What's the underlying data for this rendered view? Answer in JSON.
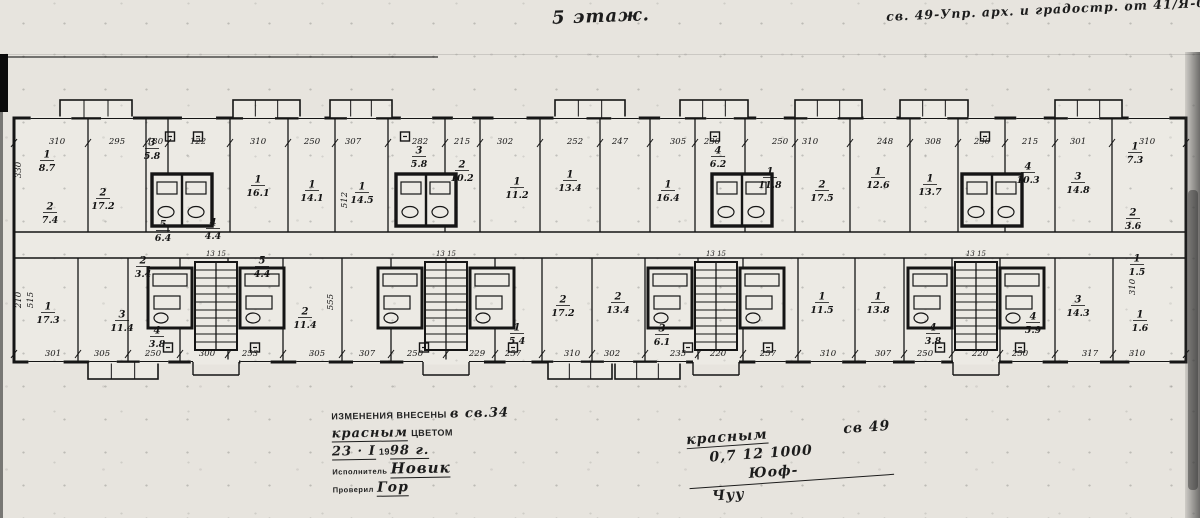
{
  "annotations": {
    "floor_label": "5 этаж.",
    "top_right_note": "св. 49-Упр. арх. и градостр. от 41/Я-04 д 4",
    "stamp_block": {
      "line1_stamp": "ИЗМЕНЕНИЯ ВНЕСЕНЫ",
      "line1_hand": "в св.34",
      "line2_hand": "красным",
      "line2_stamp": "ЦВЕТОМ",
      "line3_hand_day": "23 · I",
      "line3_stamp_year": "19",
      "line3_hand_year": "98 г.",
      "line4_stamp": "Исполнитель",
      "line4_hand": "Новик",
      "line5_stamp": "Проверил",
      "line5_hand": "Гор"
    },
    "center_note": {
      "l1a": "красным",
      "l1b": "св 49",
      "l2": "0,7  12   1000",
      "sig1": "Юоф-",
      "sig2": "Чуу"
    }
  },
  "colors": {
    "paper": "#e7e4de",
    "paper2": "#eceae4",
    "ink": "#151515"
  },
  "plan": {
    "outline": {
      "x": 14,
      "y": 118,
      "w": 1172,
      "h": 244
    },
    "corridor_y": [
      232,
      258
    ],
    "upper_walls_x": [
      88,
      146,
      168,
      230,
      288,
      335,
      388,
      445,
      480,
      540,
      600,
      650,
      695,
      745,
      795,
      850,
      910,
      958,
      1005,
      1055,
      1112
    ],
    "lower_walls_x": [
      78,
      128,
      180,
      228,
      283,
      342,
      391,
      446,
      495,
      542,
      592,
      645,
      698,
      743,
      798,
      855,
      904,
      952,
      1000,
      1055,
      1113
    ],
    "balconies_top": [
      [
        60,
        132
      ],
      [
        233,
        300
      ],
      [
        330,
        392
      ],
      [
        555,
        625
      ],
      [
        680,
        748
      ],
      [
        795,
        862
      ],
      [
        900,
        968
      ],
      [
        1055,
        1122
      ]
    ],
    "balconies_bottom": [
      [
        88,
        158
      ],
      [
        548,
        612
      ],
      [
        615,
        680
      ]
    ],
    "stairs_x": [
      195,
      425,
      695,
      955
    ],
    "stair_numbers": "13  15",
    "baths_upper_x": [
      152,
      396,
      712,
      962
    ],
    "baths_lower_x": [
      148,
      240,
      378,
      470,
      648,
      740,
      908,
      1000
    ],
    "vents_top_x": [
      170,
      198,
      405,
      715,
      985
    ],
    "vents_bottom_x": [
      168,
      255,
      424,
      513,
      688,
      768,
      940,
      1020
    ],
    "top_dims": [
      {
        "v": "310",
        "x": 57
      },
      {
        "v": "295",
        "x": 117
      },
      {
        "v": "130",
        "x": 155
      },
      {
        "v": "122",
        "x": 198
      },
      {
        "v": "310",
        "x": 258
      },
      {
        "v": "250",
        "x": 312
      },
      {
        "v": "307",
        "x": 353
      },
      {
        "v": "282",
        "x": 420
      },
      {
        "v": "215",
        "x": 462
      },
      {
        "v": "302",
        "x": 505
      },
      {
        "v": "252",
        "x": 575
      },
      {
        "v": "247",
        "x": 620
      },
      {
        "v": "305",
        "x": 678
      },
      {
        "v": "230",
        "x": 712
      },
      {
        "v": "250",
        "x": 780
      },
      {
        "v": "310",
        "x": 810
      },
      {
        "v": "248",
        "x": 885
      },
      {
        "v": "308",
        "x": 933
      },
      {
        "v": "230",
        "x": 982
      },
      {
        "v": "215",
        "x": 1030
      },
      {
        "v": "301",
        "x": 1078
      },
      {
        "v": "310",
        "x": 1147
      }
    ],
    "bottom_dims": [
      {
        "v": "301",
        "x": 53
      },
      {
        "v": "305",
        "x": 102
      },
      {
        "v": "250",
        "x": 153
      },
      {
        "v": "300",
        "x": 207
      },
      {
        "v": "253",
        "x": 250
      },
      {
        "v": "305",
        "x": 317
      },
      {
        "v": "307",
        "x": 367
      },
      {
        "v": "250",
        "x": 415
      },
      {
        "v": "229",
        "x": 477
      },
      {
        "v": "257",
        "x": 513
      },
      {
        "v": "310",
        "x": 572
      },
      {
        "v": "302",
        "x": 612
      },
      {
        "v": "235",
        "x": 678
      },
      {
        "v": "220",
        "x": 718
      },
      {
        "v": "257",
        "x": 768
      },
      {
        "v": "310",
        "x": 828
      },
      {
        "v": "307",
        "x": 883
      },
      {
        "v": "250",
        "x": 925
      },
      {
        "v": "220",
        "x": 980
      },
      {
        "v": "250",
        "x": 1020
      },
      {
        "v": "317",
        "x": 1090
      },
      {
        "v": "310",
        "x": 1137
      }
    ],
    "vertical_dims": [
      {
        "v": "330",
        "x": 21,
        "y": 170
      },
      {
        "v": "210",
        "x": 21,
        "y": 300
      },
      {
        "v": "515",
        "x": 33,
        "y": 300
      },
      {
        "v": "512",
        "x": 347,
        "y": 200
      },
      {
        "v": "555",
        "x": 333,
        "y": 302
      },
      {
        "v": "310",
        "x": 1135,
        "y": 287
      }
    ],
    "room_labels_upper": [
      {
        "n": "1",
        "a": "8.7",
        "x": 47,
        "y": 160
      },
      {
        "n": "2",
        "a": "7.4",
        "x": 50,
        "y": 212
      },
      {
        "n": "2",
        "a": "17.2",
        "x": 103,
        "y": 198
      },
      {
        "n": "3",
        "a": "5.8",
        "x": 152,
        "y": 148
      },
      {
        "n": "5",
        "a": "6.4",
        "x": 163,
        "y": 230
      },
      {
        "n": "4",
        "a": "4.4",
        "x": 213,
        "y": 228
      },
      {
        "n": "1",
        "a": "16.1",
        "x": 258,
        "y": 185
      },
      {
        "n": "1",
        "a": "14.1",
        "x": 312,
        "y": 190
      },
      {
        "n": "1",
        "a": "14.5",
        "x": 362,
        "y": 192
      },
      {
        "n": "3",
        "a": "5.8",
        "x": 419,
        "y": 156
      },
      {
        "n": "2",
        "a": "10.2",
        "x": 462,
        "y": 170
      },
      {
        "n": "1",
        "a": "11.2",
        "x": 517,
        "y": 187
      },
      {
        "n": "1",
        "a": "13.4",
        "x": 570,
        "y": 180
      },
      {
        "n": "1",
        "a": "16.4",
        "x": 668,
        "y": 190
      },
      {
        "n": "4",
        "a": "6.2",
        "x": 718,
        "y": 156
      },
      {
        "n": "1",
        "a": "11.8",
        "x": 770,
        "y": 177
      },
      {
        "n": "2",
        "a": "17.5",
        "x": 822,
        "y": 190
      },
      {
        "n": "1",
        "a": "12.6",
        "x": 878,
        "y": 177
      },
      {
        "n": "1",
        "a": "13.7",
        "x": 930,
        "y": 184
      },
      {
        "n": "4",
        "a": "10.3",
        "x": 1028,
        "y": 172
      },
      {
        "n": "3",
        "a": "14.8",
        "x": 1078,
        "y": 182
      },
      {
        "n": "1",
        "a": "7.3",
        "x": 1135,
        "y": 152
      },
      {
        "n": "2",
        "a": "3.6",
        "x": 1133,
        "y": 218
      }
    ],
    "room_labels_lower": [
      {
        "n": "1",
        "a": "17.3",
        "x": 48,
        "y": 312
      },
      {
        "n": "3",
        "a": "11.4",
        "x": 122,
        "y": 320
      },
      {
        "n": "2",
        "a": "3.4",
        "x": 143,
        "y": 266
      },
      {
        "n": "5",
        "a": "4.4",
        "x": 262,
        "y": 266
      },
      {
        "n": "2",
        "a": "11.4",
        "x": 305,
        "y": 317
      },
      {
        "n": "4",
        "a": "3.8",
        "x": 157,
        "y": 336
      },
      {
        "n": "1",
        "a": "5.4",
        "x": 517,
        "y": 333
      },
      {
        "n": "2",
        "a": "17.2",
        "x": 563,
        "y": 305
      },
      {
        "n": "2",
        "a": "13.4",
        "x": 618,
        "y": 302
      },
      {
        "n": "3",
        "a": "6.1",
        "x": 662,
        "y": 334
      },
      {
        "n": "1",
        "a": "11.5",
        "x": 822,
        "y": 302
      },
      {
        "n": "1",
        "a": "13.8",
        "x": 878,
        "y": 302
      },
      {
        "n": "4",
        "a": "3.8",
        "x": 933,
        "y": 333
      },
      {
        "n": "4",
        "a": "5.9",
        "x": 1033,
        "y": 322
      },
      {
        "n": "3",
        "a": "14.3",
        "x": 1078,
        "y": 305
      },
      {
        "n": "1",
        "a": "1.5",
        "x": 1137,
        "y": 264
      },
      {
        "n": "1",
        "a": "1.6",
        "x": 1140,
        "y": 320
      }
    ]
  }
}
